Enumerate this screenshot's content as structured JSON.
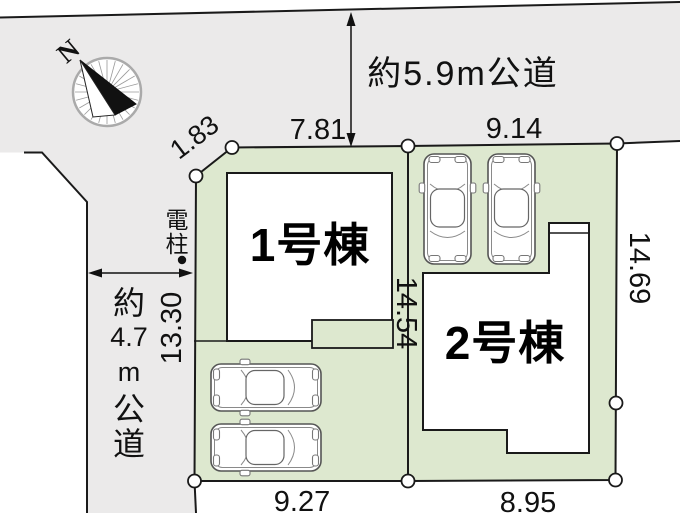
{
  "colors": {
    "road": "#ebeaea",
    "parcel": "#dde8cf",
    "line": "#1a1a1a",
    "building": "#ffffff",
    "car_stroke": "#555555",
    "compass_ring": "#aaaaaa"
  },
  "compass": {
    "north_label": "N"
  },
  "roads": {
    "top_label": "約5.9m公道",
    "left_label_chars": [
      "約",
      "4.7",
      "m",
      "公",
      "道"
    ]
  },
  "utility_pole": {
    "label_chars": [
      "電",
      "柱"
    ]
  },
  "buildings": {
    "b1": "1号棟",
    "b2": "2号棟"
  },
  "dimensions": {
    "chamfer": "1.83",
    "lot1_top": "7.81",
    "lot2_top": "9.14",
    "lot1_left": "13.30",
    "center": "14.54",
    "lot2_right": "14.69",
    "lot1_bottom": "9.27",
    "lot2_bottom": "8.95"
  }
}
